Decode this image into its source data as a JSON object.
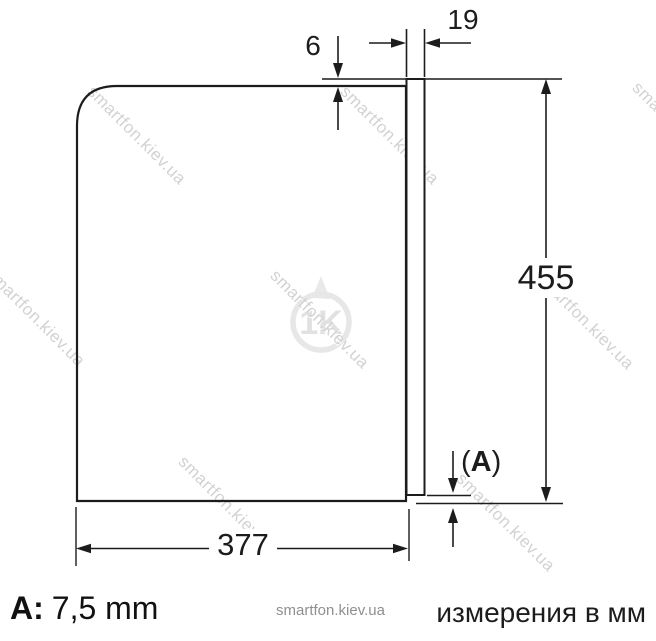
{
  "drawing": {
    "dims": {
      "top_gap": "6",
      "door_thickness": "19",
      "height": "455",
      "width": "377",
      "gap_open": "(",
      "gap_letter": "A",
      "gap_close": ")"
    },
    "legend": {
      "key": "A:",
      "value": "7,5 mm"
    },
    "footer": {
      "site": "smartfon.kiev.ua",
      "units_note": "измерения в мм"
    },
    "watermark": {
      "text": "smartfon.kiev.ua",
      "logo_text": "1K"
    },
    "colors": {
      "line": "#1c1c1c",
      "watermark": "#d2d2d2",
      "muted_text": "#8f8f8f"
    }
  }
}
